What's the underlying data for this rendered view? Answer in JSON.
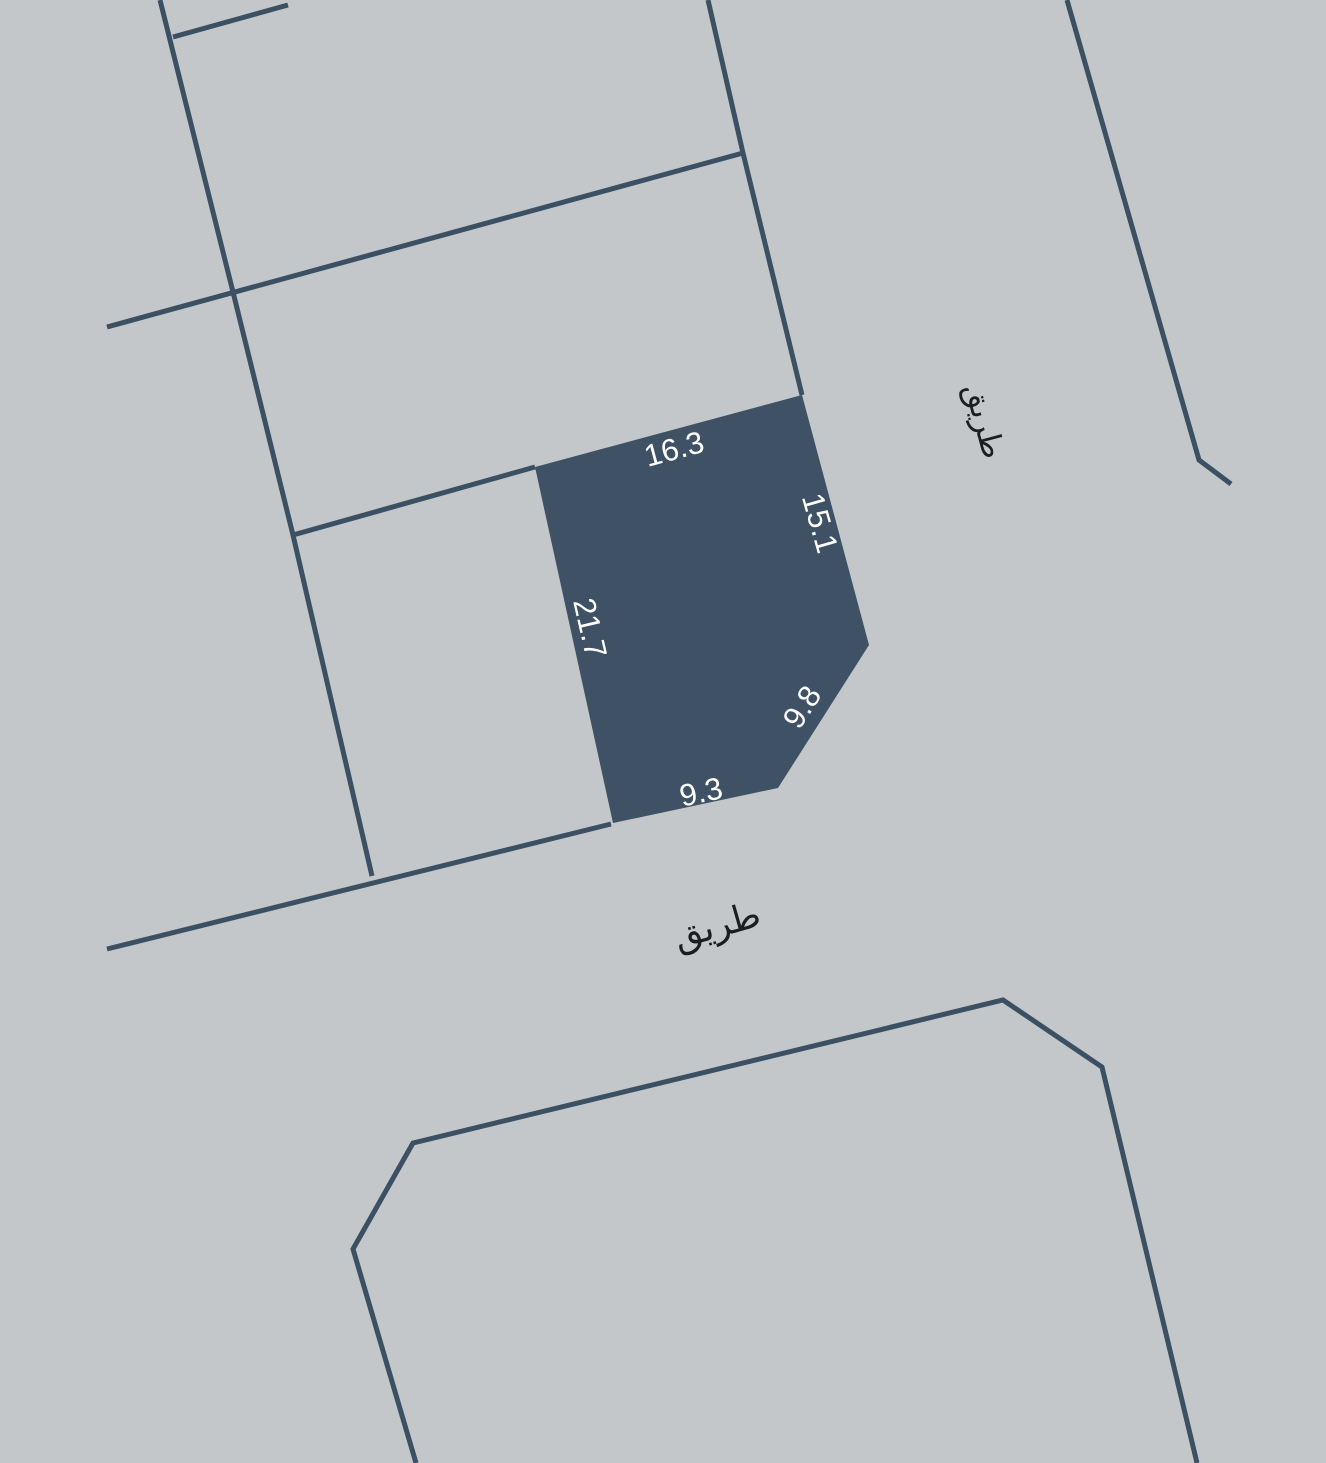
{
  "map": {
    "background": "#c3c7ca",
    "line_color": "#3c5063",
    "parcel": {
      "fill": "#3f5265",
      "label_color": "#ffffff",
      "points": "535,467 802,395 869,645 778,788 613,823",
      "dimensions": [
        {
          "value": "16.3",
          "x": 674,
          "y": 449,
          "angle": -15
        },
        {
          "value": "15.1",
          "x": 820,
          "y": 523,
          "angle": 74
        },
        {
          "value": "21.7",
          "x": 590,
          "y": 628,
          "angle": 77
        },
        {
          "value": "9.8",
          "x": 802,
          "y": 707,
          "angle": -57
        },
        {
          "value": "9.3",
          "x": 701,
          "y": 792,
          "angle": -12
        }
      ]
    },
    "roads": [
      {
        "label": "طريق",
        "x": 984,
        "y": 421,
        "angle": 75,
        "size": 31,
        "color": "#1b1e21"
      },
      {
        "label": "طريق",
        "x": 717,
        "y": 926,
        "angle": -16,
        "size": 36,
        "color": "#1b1e21"
      }
    ],
    "boundaries": [
      {
        "name": "west-block-boundary",
        "points": "160,0 233,292 293,535 372,876"
      },
      {
        "name": "north-short-boundary",
        "points": "173,37 288,5"
      },
      {
        "name": "north-street-boundary",
        "points": "107,327 743,153"
      },
      {
        "name": "northeast-parcel-boundary",
        "points": "708,0 743,153 802,395"
      },
      {
        "name": "west-parcel-boundary",
        "points": "293,535 535,467"
      },
      {
        "name": "south-street-boundary",
        "points": "107,949 611,824"
      },
      {
        "name": "east-street-boundary",
        "points": "1067,0 1199,460 1231,484"
      },
      {
        "name": "south-block-boundary",
        "points": "416,1463 353,1249 413,1143 1003,1000 1102,1067 1197,1463"
      }
    ]
  }
}
